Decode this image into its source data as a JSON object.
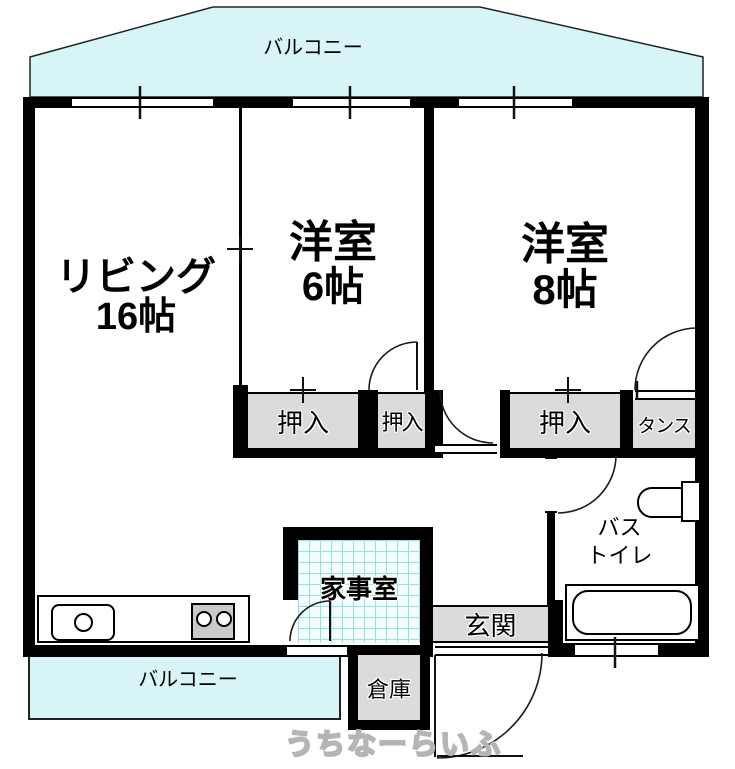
{
  "plan": {
    "type": "japanese-apartment-floor-plan",
    "balconies": {
      "top": "バルコニー",
      "bottom": "バルコニー"
    },
    "rooms": {
      "living": {
        "name": "リビング",
        "size": "16帖"
      },
      "western6": {
        "name": "洋室",
        "size": "6帖"
      },
      "western8": {
        "name": "洋室",
        "size": "8帖"
      },
      "utility": {
        "name": "家事室"
      },
      "bath": {
        "line1": "バス",
        "line2": "トイレ"
      },
      "entrance": {
        "name": "玄関"
      },
      "storage_room": {
        "name": "倉庫"
      }
    },
    "closets": {
      "oshiire": "押入",
      "tansu": "タンス"
    },
    "fixtures": [
      "kitchen-sink",
      "stove-two-burner",
      "bathtub",
      "toilet"
    ],
    "watermark": {
      "text": "うちなーらいふ"
    },
    "colors": {
      "wall": "#000000",
      "balcony_fill": "#d7f4f6",
      "storage_gray": "#dbdbdb",
      "utility_checker_line": "#9adde2",
      "utility_checker_bg": "#f4fdfe",
      "line": "#1a1a1a",
      "watermark_gray": "#b5b5b5"
    }
  }
}
